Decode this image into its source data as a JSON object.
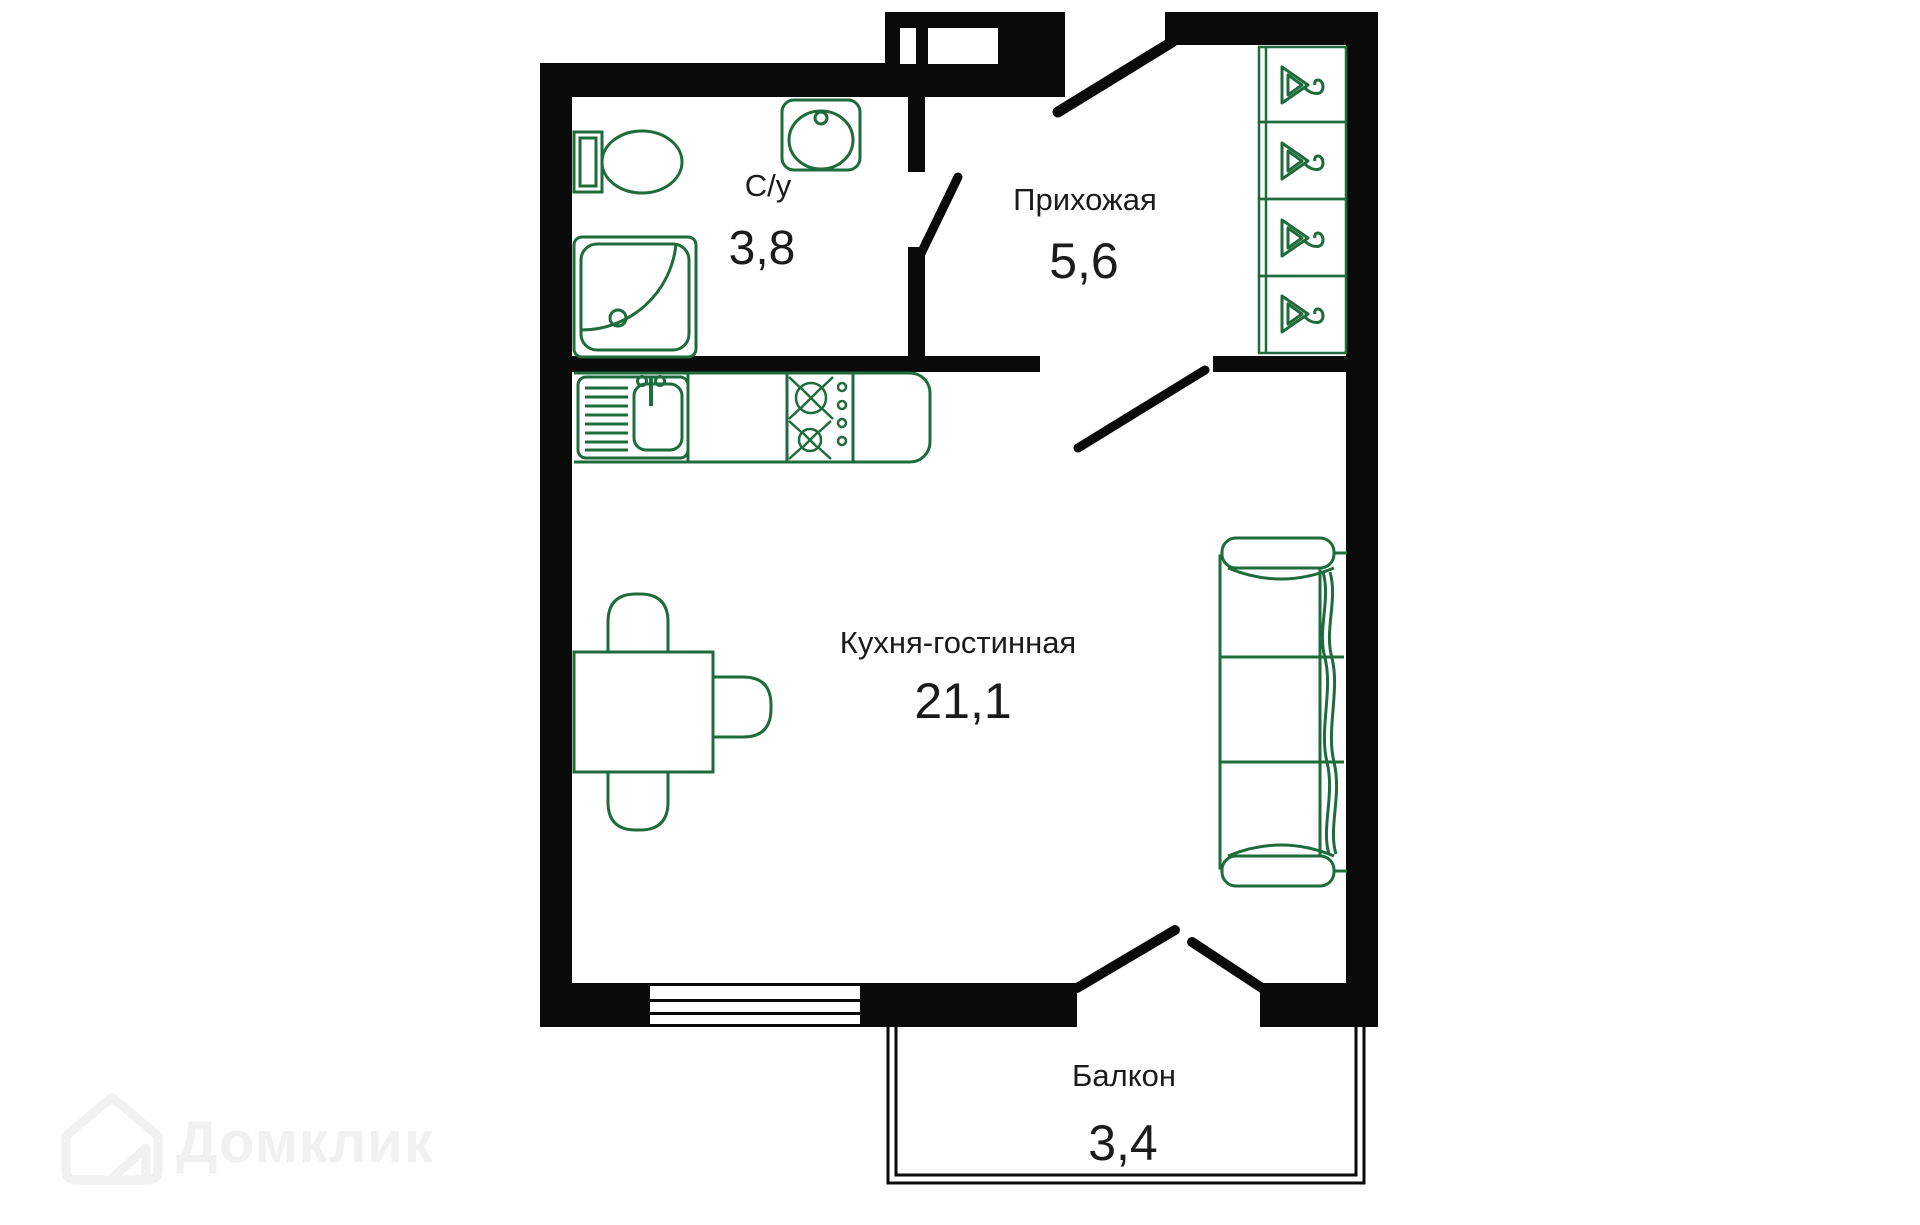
{
  "floor_plan": {
    "rooms": [
      {
        "id": "bathroom",
        "label": "С/у",
        "area": "3,8"
      },
      {
        "id": "hallway",
        "label": "Прихожая",
        "area": "5,6"
      },
      {
        "id": "kitchen_living",
        "label": "Кухня-гостинная",
        "area": "21,1"
      },
      {
        "id": "balcony",
        "label": "Балкон",
        "area": "3,4"
      }
    ],
    "icons": [
      "toilet-icon",
      "shower-icon",
      "bathroom-sink-icon",
      "kitchen-sink-icon",
      "stove-icon",
      "dining-table-icon",
      "chair-icon",
      "sofa-icon",
      "hanger-icon",
      "window-icon",
      "entrance-door-icon",
      "interior-door-icon",
      "balcony-door-icon"
    ],
    "colors": {
      "walls": "#0a0a0a",
      "furniture": "#1e6b3c",
      "text": "#1b1b1b",
      "watermark": "#f1f1f1",
      "background": "#ffffff"
    },
    "watermark": {
      "brand": "Домклик"
    }
  }
}
